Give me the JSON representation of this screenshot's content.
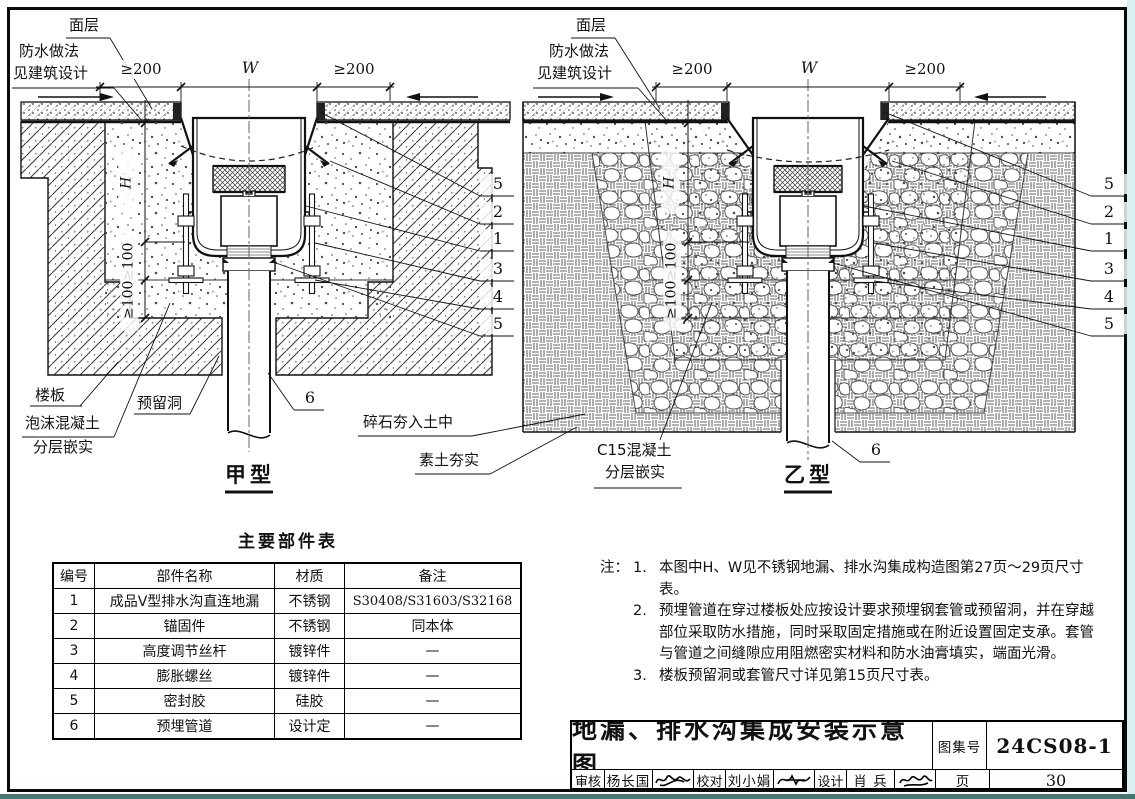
{
  "diagram_a": {
    "type_label": "甲型",
    "surface_label": "面层",
    "waterproof_line1": "防水做法",
    "waterproof_line2": "见建筑设计",
    "slab_label": "楼板",
    "reserved_hole_label": "预留洞",
    "foam_line1": "泡沫混凝土",
    "foam_line2": "分层嵌实",
    "dim_left": "≥200",
    "dim_width": "W",
    "dim_right": "≥200",
    "dim_depth": "H",
    "dim_v1": "≥100",
    "dim_v2": "≥100",
    "callouts": [
      "5",
      "2",
      "1",
      "3",
      "4",
      "5"
    ],
    "pipe_callout": "6"
  },
  "diagram_b": {
    "type_label": "乙型",
    "surface_label": "面层",
    "waterproof_line1": "防水做法",
    "waterproof_line2": "见建筑设计",
    "gravel_label": "碎石夯入土中",
    "soil_label": "素土夯实",
    "concrete_line1": "C15混凝土",
    "concrete_line2": "分层嵌实",
    "dim_left": "≥200",
    "dim_width": "W",
    "dim_right": "≥200",
    "dim_depth": "H",
    "dim_v1": "≥100",
    "dim_v2": "≥100",
    "callouts": [
      "5",
      "2",
      "1",
      "3",
      "4",
      "5"
    ],
    "pipe_callout": "6"
  },
  "parts_table": {
    "title": "主要部件表",
    "headers": [
      "编号",
      "部件名称",
      "材质",
      "备注"
    ],
    "rows": [
      [
        "1",
        "成品V型排水沟直连地漏",
        "不锈钢",
        "S30408/S31603/S32168"
      ],
      [
        "2",
        "锚固件",
        "不锈钢",
        "同本体"
      ],
      [
        "3",
        "高度调节丝杆",
        "镀锌件",
        "—"
      ],
      [
        "4",
        "膨胀螺丝",
        "镀锌件",
        "—"
      ],
      [
        "5",
        "密封胶",
        "硅胶",
        "—"
      ],
      [
        "6",
        "预埋管道",
        "设计定",
        "—"
      ]
    ]
  },
  "notes": {
    "prefix": "注：",
    "items": [
      {
        "no": "1.",
        "text": "本图中H、W见不锈钢地漏、排水沟集成构造图第27页～29页尺寸表。"
      },
      {
        "no": "2.",
        "text": "预埋管道在穿过楼板处应按设计要求预埋钢套管或预留洞，并在穿越部位采取防水措施，同时采取固定措施或在附近设置固定支承。套管与管道之间缝隙应用阻燃密实材料和防水油膏填实，端面光滑。"
      },
      {
        "no": "3.",
        "text": "楼板预留洞或套管尺寸详见第15页尺寸表。"
      }
    ]
  },
  "title_block": {
    "title": "地漏、排水沟集成安装示意图",
    "atlas_label": "图集号",
    "atlas_no": "24CS08-1",
    "page_label": "页",
    "page_no": "30",
    "reviewer_label": "审核",
    "reviewer": "杨长国",
    "proofreader_label": "校对",
    "proofreader": "刘小娟",
    "designer_label": "设计",
    "designer": "肖 兵"
  }
}
